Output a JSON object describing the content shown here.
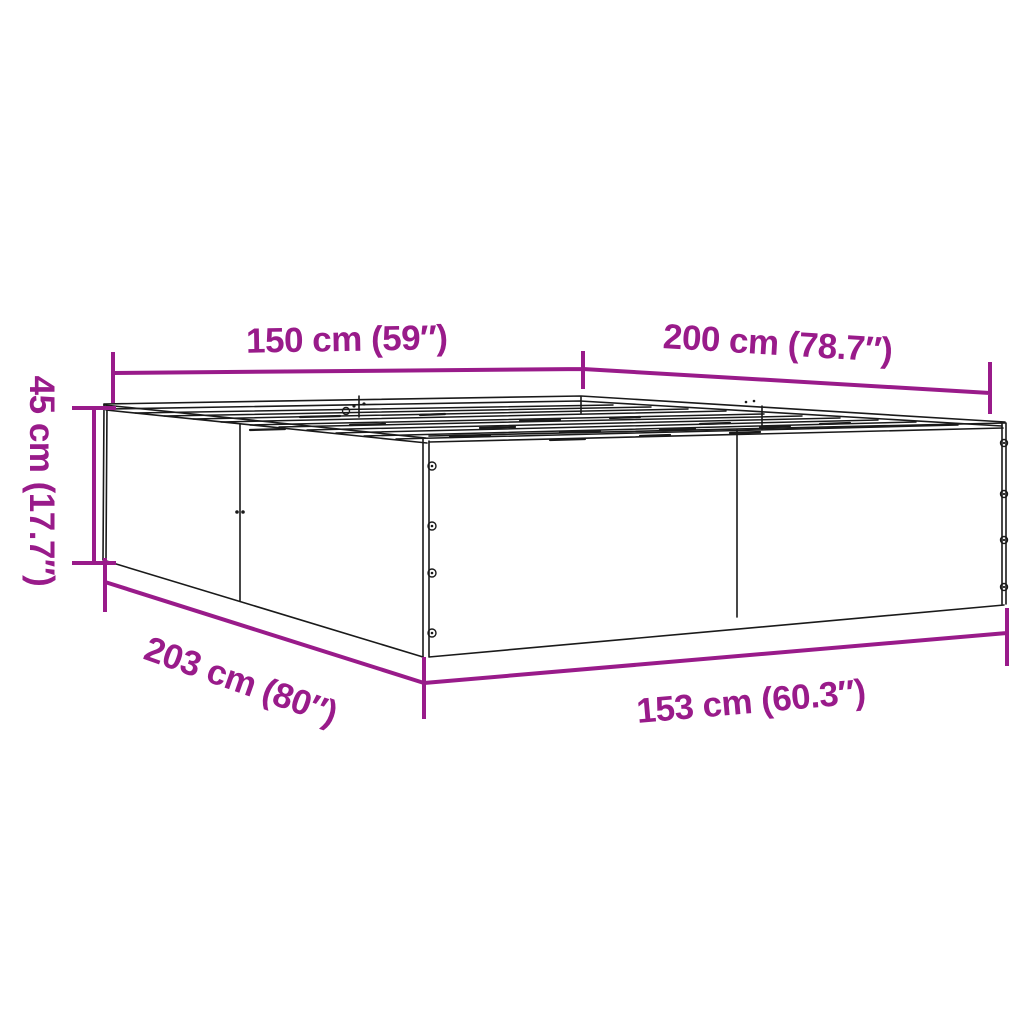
{
  "page": {
    "background_color": "#FFFFFF"
  },
  "diagram": {
    "type": "product-dimension-diagram",
    "subject": "bed-frame",
    "accent_color": "#991B8A",
    "line_color": "#1A1A1A",
    "dimensions": {
      "top_width": {
        "label": "150 cm (59″)",
        "cm": "150",
        "inches": "59"
      },
      "top_length": {
        "label": "200 cm (78.7″)",
        "cm": "200",
        "inches": "78.7"
      },
      "height": {
        "label": "45 cm (17.7″)",
        "cm": "45",
        "inches": "17.7"
      },
      "outer_length": {
        "label": "203 cm (80″)",
        "cm": "203",
        "inches": "80"
      },
      "outer_width": {
        "label": "153 cm (60.3″)",
        "cm": "153",
        "inches": "60.3"
      }
    }
  }
}
